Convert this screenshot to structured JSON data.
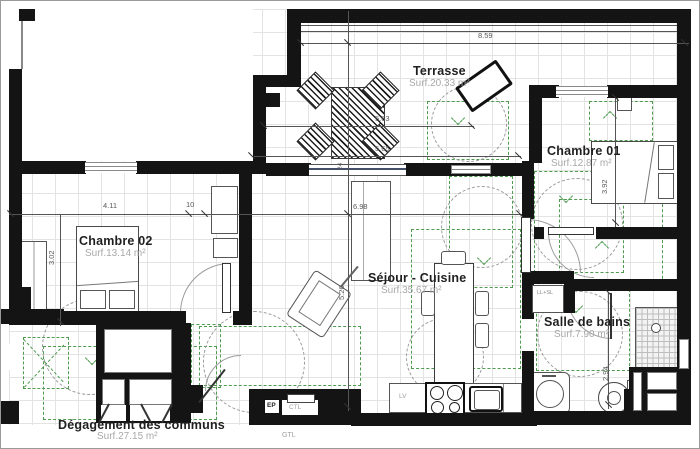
{
  "rooms": {
    "terrasse": {
      "name": "Terrasse",
      "area": "Surf.20.33 m²"
    },
    "chambre01": {
      "name": "Chambre 01",
      "area": "Surf.12.87 m²"
    },
    "chambre02": {
      "name": "Chambre 02",
      "area": "Surf.13.14 m²"
    },
    "sejour": {
      "name": "Séjour - Cuisine",
      "area": "Surf.35.67 m²"
    },
    "sdb": {
      "name": "Salle de bains",
      "area": "Surf.7.90 m²"
    },
    "degagement": {
      "name": "Dégagement des communs",
      "area": "Surf.27.15 m²"
    }
  },
  "dimensions": {
    "total_width": "8.59",
    "terrasse_upper": "5.63",
    "terrasse_lower": "5.65",
    "chambre02_width": "4.11",
    "wall_thickness": "10",
    "sejour_width": "6.98",
    "chambre02_height": "3.02",
    "sejour_height": "5.26",
    "chambre01_height": "3.92",
    "sdb_height": "2.94",
    "bay_width": "24"
  },
  "annotations": {
    "washer_dryer": "LL+SL",
    "dishwasher": "LV",
    "ep": "EP",
    "ctl": "CTL",
    "gtl": "GTL"
  },
  "colors": {
    "wall": "#141414",
    "accessibility_green": "#4e9b50",
    "grid": "#e3e3e3",
    "dimension_text": "#5a5a5a"
  }
}
